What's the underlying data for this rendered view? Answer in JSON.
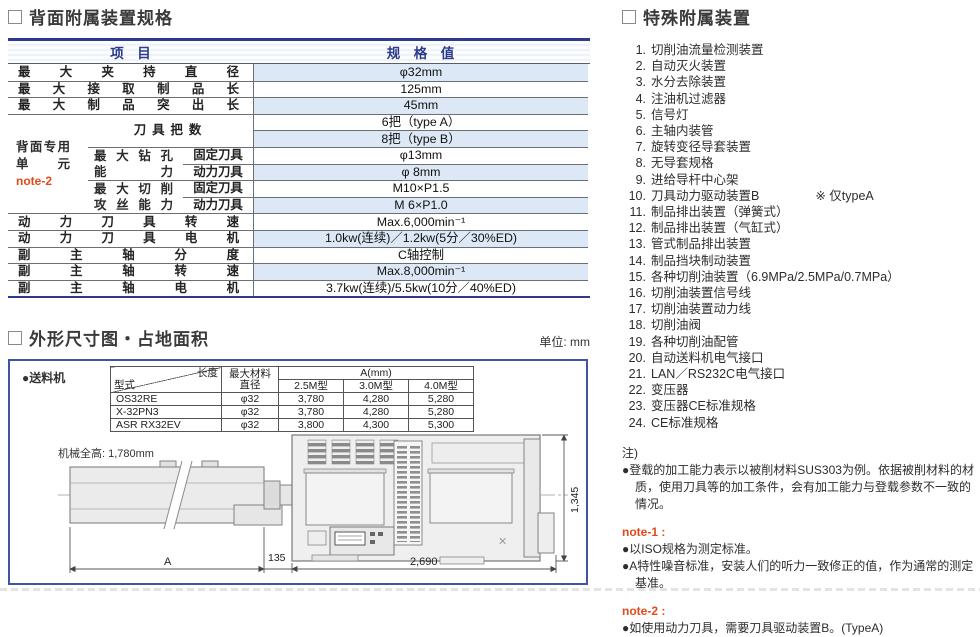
{
  "spec": {
    "title": "背面附属装置规格",
    "col_item": "项　目",
    "col_value": "规　格　值",
    "r1_label": "最大夹持直径",
    "r1_value": "φ32mm",
    "r2_label": "最大接取制品长",
    "r2_value": "125mm",
    "r3_label": "最大制品突出长",
    "r3_value": "45mm",
    "group_line1": "背面专用",
    "group_line2": "单元",
    "group_note": "note-2",
    "tools_label": "刀具把数",
    "tools_value_a": "6把（type A）",
    "tools_value_b": "8把（type B）",
    "drill_label_1": "最大钻孔",
    "drill_label_2": "能力",
    "tap_label_1": "最大切削",
    "tap_label_2": "攻丝能力",
    "fixed_tool": "固定刀具",
    "power_tool": "动力刀具",
    "drill_fixed_value": "φ13mm",
    "drill_power_value": "φ 8mm",
    "tap_fixed_value": "M10×P1.5",
    "tap_power_value": "M 6×P1.0",
    "r10_label": "动力刀具转速",
    "r10_value": "Max.6,000min⁻¹",
    "r11_label": "动力刀具电机",
    "r11_value": "1.0kw(连续)／1.2kw(5分／30%ED)",
    "r12_label": "副主轴分度",
    "r12_value": "C轴控制",
    "r13_label": "副主轴转速",
    "r13_value": "Max.8,000min⁻¹",
    "r14_label": "副主轴电机",
    "r14_value": "3.7kw(连续)/5.5kw(10分／40%ED)"
  },
  "dims": {
    "title": "外形尺寸图・占地面积",
    "unit": "单位: mm",
    "feeder_label": "●送料机",
    "feeder_table": {
      "corner_top": "长度",
      "corner_bottom": "型式",
      "col_dia": "最大材料直径",
      "col_a": "A(mm)",
      "sub_25": "2.5M型",
      "sub_30": "3.0M型",
      "sub_40": "4.0M型",
      "rows": [
        {
          "model": "OS32RE",
          "dia": "φ32",
          "a25": "3,780",
          "a30": "4,280",
          "a40": "5,280"
        },
        {
          "model": "X-32PN3",
          "dia": "φ32",
          "a25": "3,780",
          "a30": "4,280",
          "a40": "5,280"
        },
        {
          "model": "ASR RX32EV",
          "dia": "φ32",
          "a25": "3,800",
          "a30": "4,300",
          "a40": "5,300"
        }
      ]
    },
    "height_label": "机械全高: 1,780mm",
    "dim_a": "A",
    "dim_135": "135",
    "dim_2690": "2,690",
    "dim_1345": "1,345"
  },
  "special": {
    "title": "特殊附属装置",
    "items": [
      "切削油流量检测装置",
      "自动灭火装置",
      "水分去除装置",
      "注油机过滤器",
      "信号灯",
      "主轴内装管",
      "旋转变径导套装置",
      "无导套规格",
      "进给导杆中心架",
      "刀具动力驱动装置B",
      "制品排出装置（弹簧式）",
      "制品排出装置（气缸式）",
      "管式制品排出装置",
      "制品挡块制动装置",
      "各种切削油装置（6.9MPa/2.5MPa/0.7MPa）",
      "切削油装置信号线",
      "切削油装置动力线",
      "切削油阀",
      "各种切削油配管",
      "自动送料机电气接口",
      "LAN／RS232C电气接口",
      "变压器",
      "变压器CE标准规格",
      "CE标准规格"
    ],
    "item10_note": "※ 仅typeA"
  },
  "notes": {
    "head": "注)",
    "general": "●登载的加工能力表示以被削材料SUS303为例。依据被削材料的材质，使用刀具等的加工条件，会有加工能力与登载参数不一致的情况。",
    "note1_label": "note-1 :",
    "note1_a": "●以ISO规格为测定标准。",
    "note1_b": "●A特性噪音标准，安装人们的听力一致修正的值，作为通常的测定基准。",
    "note2_label": "note-2 :",
    "note2_a": "●如使用动力刀具，需要刀具驱动装置B。(TypeA)"
  }
}
